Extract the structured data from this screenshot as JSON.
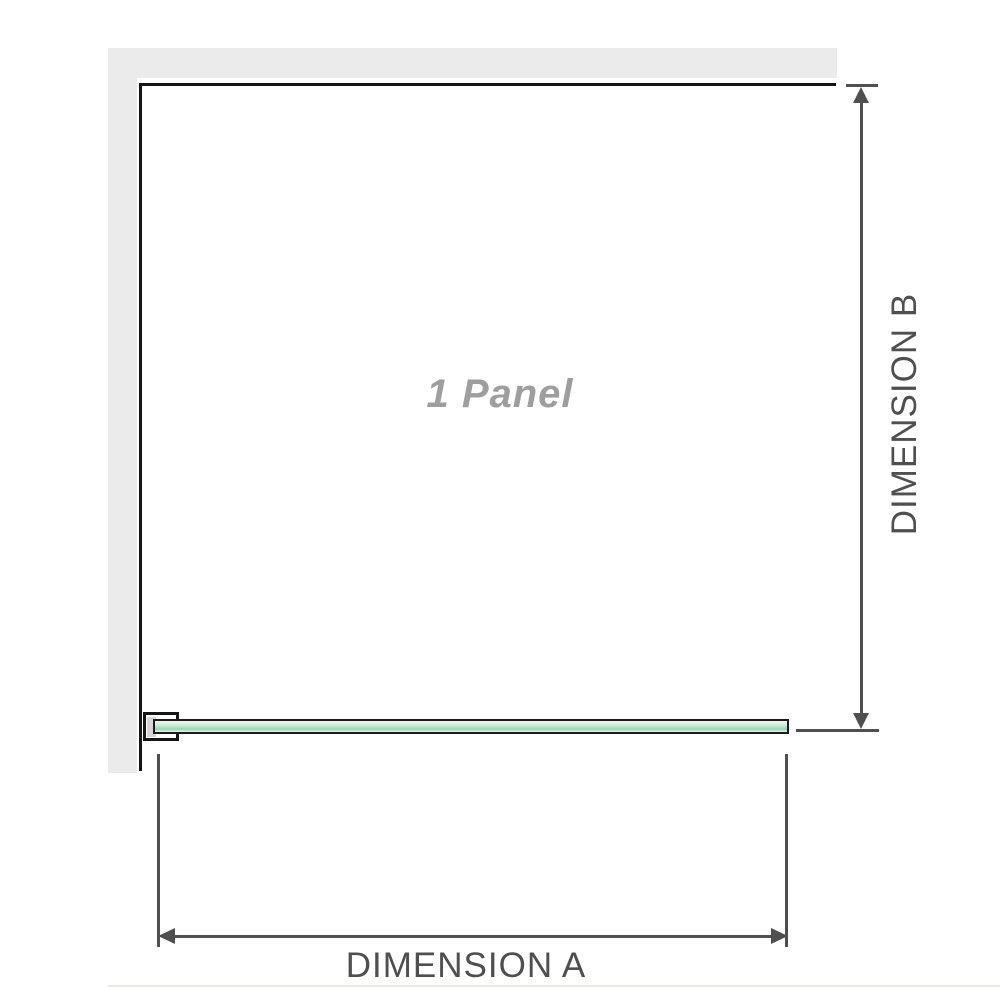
{
  "page": {
    "background": "#ffffff"
  },
  "diagram": {
    "panel_label": "1 Panel",
    "dimension_a_label": "DIMENSION A",
    "dimension_b_label": "DIMENSION B",
    "colors": {
      "page_bg": "#ffffff",
      "wall": "#ebebeb",
      "wall_edge": "#151515",
      "dimension": "#4f4f4f",
      "glass_border": "#1c1c1c",
      "glass_light": "#d8eee0",
      "glass_mid": "#96d3b3",
      "bracket_pad": "#d6d6d6",
      "panel_label_color": "#9e9e9e"
    }
  }
}
